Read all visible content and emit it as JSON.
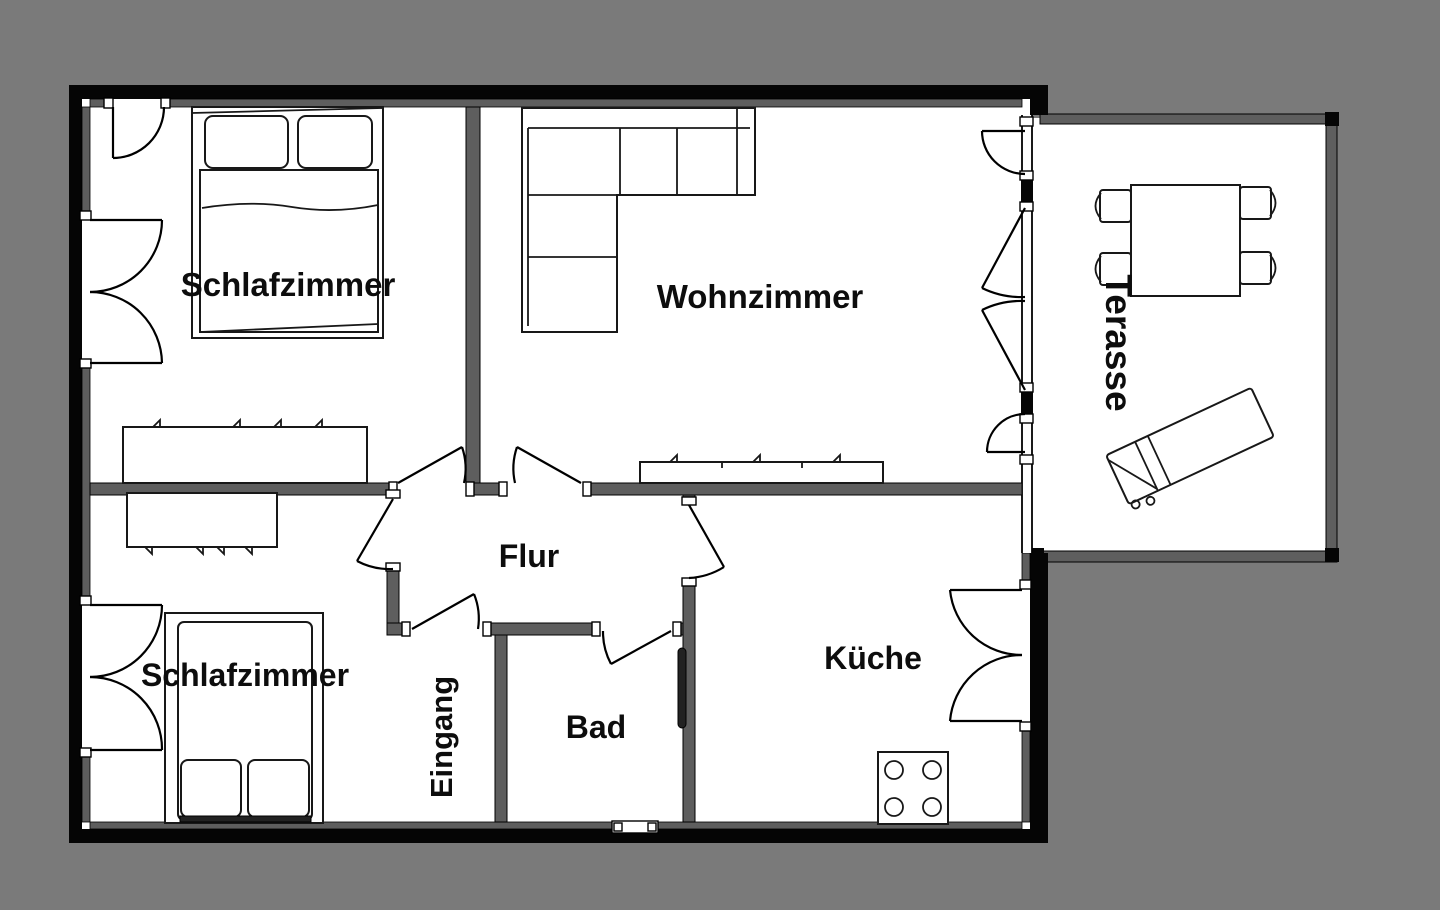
{
  "plan_title": "Wohnung Grundriss",
  "colors": {
    "background": "#7a7a7a",
    "floor": "#ffffff",
    "exterior_wall": "#050505",
    "interior_wall": "#5e5e5e",
    "label_text": "#0d0d0d"
  },
  "rooms": {
    "schlafzimmer1": {
      "label": "Schlafzimmer"
    },
    "wohnzimmer": {
      "label": "Wohnzimmer"
    },
    "schlafzimmer2": {
      "label": "Schlafzimmer"
    },
    "flur": {
      "label": "Flur"
    },
    "eingang": {
      "label": "Eingang"
    },
    "bad": {
      "label": "Bad"
    },
    "kueche": {
      "label": "Küche"
    },
    "terrasse": {
      "label": "Terasse"
    }
  }
}
